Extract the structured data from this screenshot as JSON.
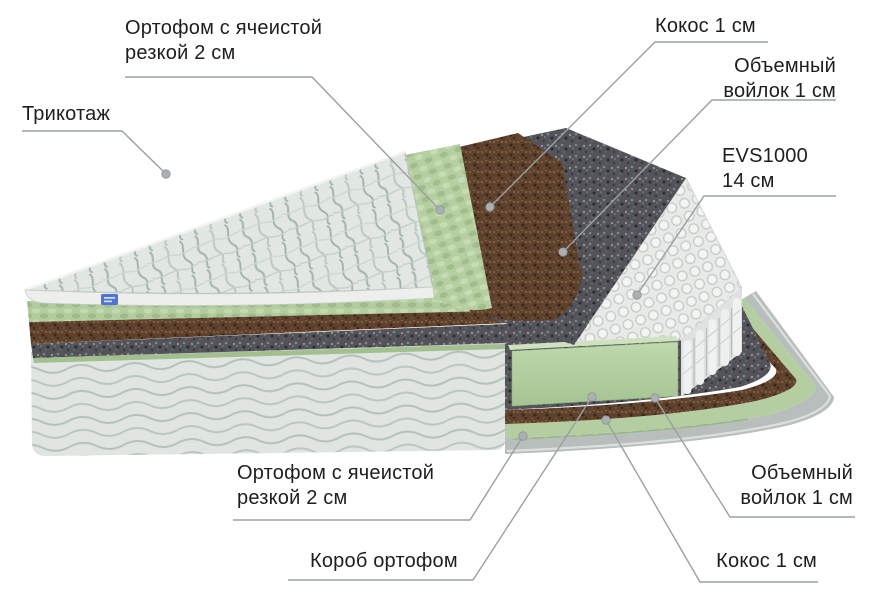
{
  "diagram": {
    "subject": "mattress-layers-cutaway",
    "labels": {
      "knit": {
        "text": "Трикотаж"
      },
      "foam_top": {
        "line1": "Ортофом с ячеистой",
        "line2": "резкой 2 см"
      },
      "coconut_top": {
        "text": "Кокос 1 см"
      },
      "felt_top": {
        "line1": "Объемный",
        "line2": "войлок 1 см"
      },
      "springs": {
        "line1": "EVS1000",
        "line2": "14 см"
      },
      "foam_bottom": {
        "line1": "Ортофом с ячеистой",
        "line2": "резкой 2 см"
      },
      "box": {
        "text": "Короб ортофом"
      },
      "felt_bottom": {
        "line1": "Объемный",
        "line2": "войлок 1 см"
      },
      "coconut_bottom": {
        "text": "Кокос 1 см"
      }
    },
    "colors": {
      "background": "#ffffff",
      "label_text": "#1d1e20",
      "leader_line": "#9aa0a3",
      "knit_fabric": "#e2e7e4",
      "foam_green": "#b5cfa1",
      "coconut_brown": "#5d412c",
      "felt_gray": "#53545a",
      "springs_white": "#e8eae8",
      "body_fabric": "#e0e5e2",
      "base_gray": "#b8bebc",
      "label_tag_blue": "#4f74d6"
    }
  }
}
